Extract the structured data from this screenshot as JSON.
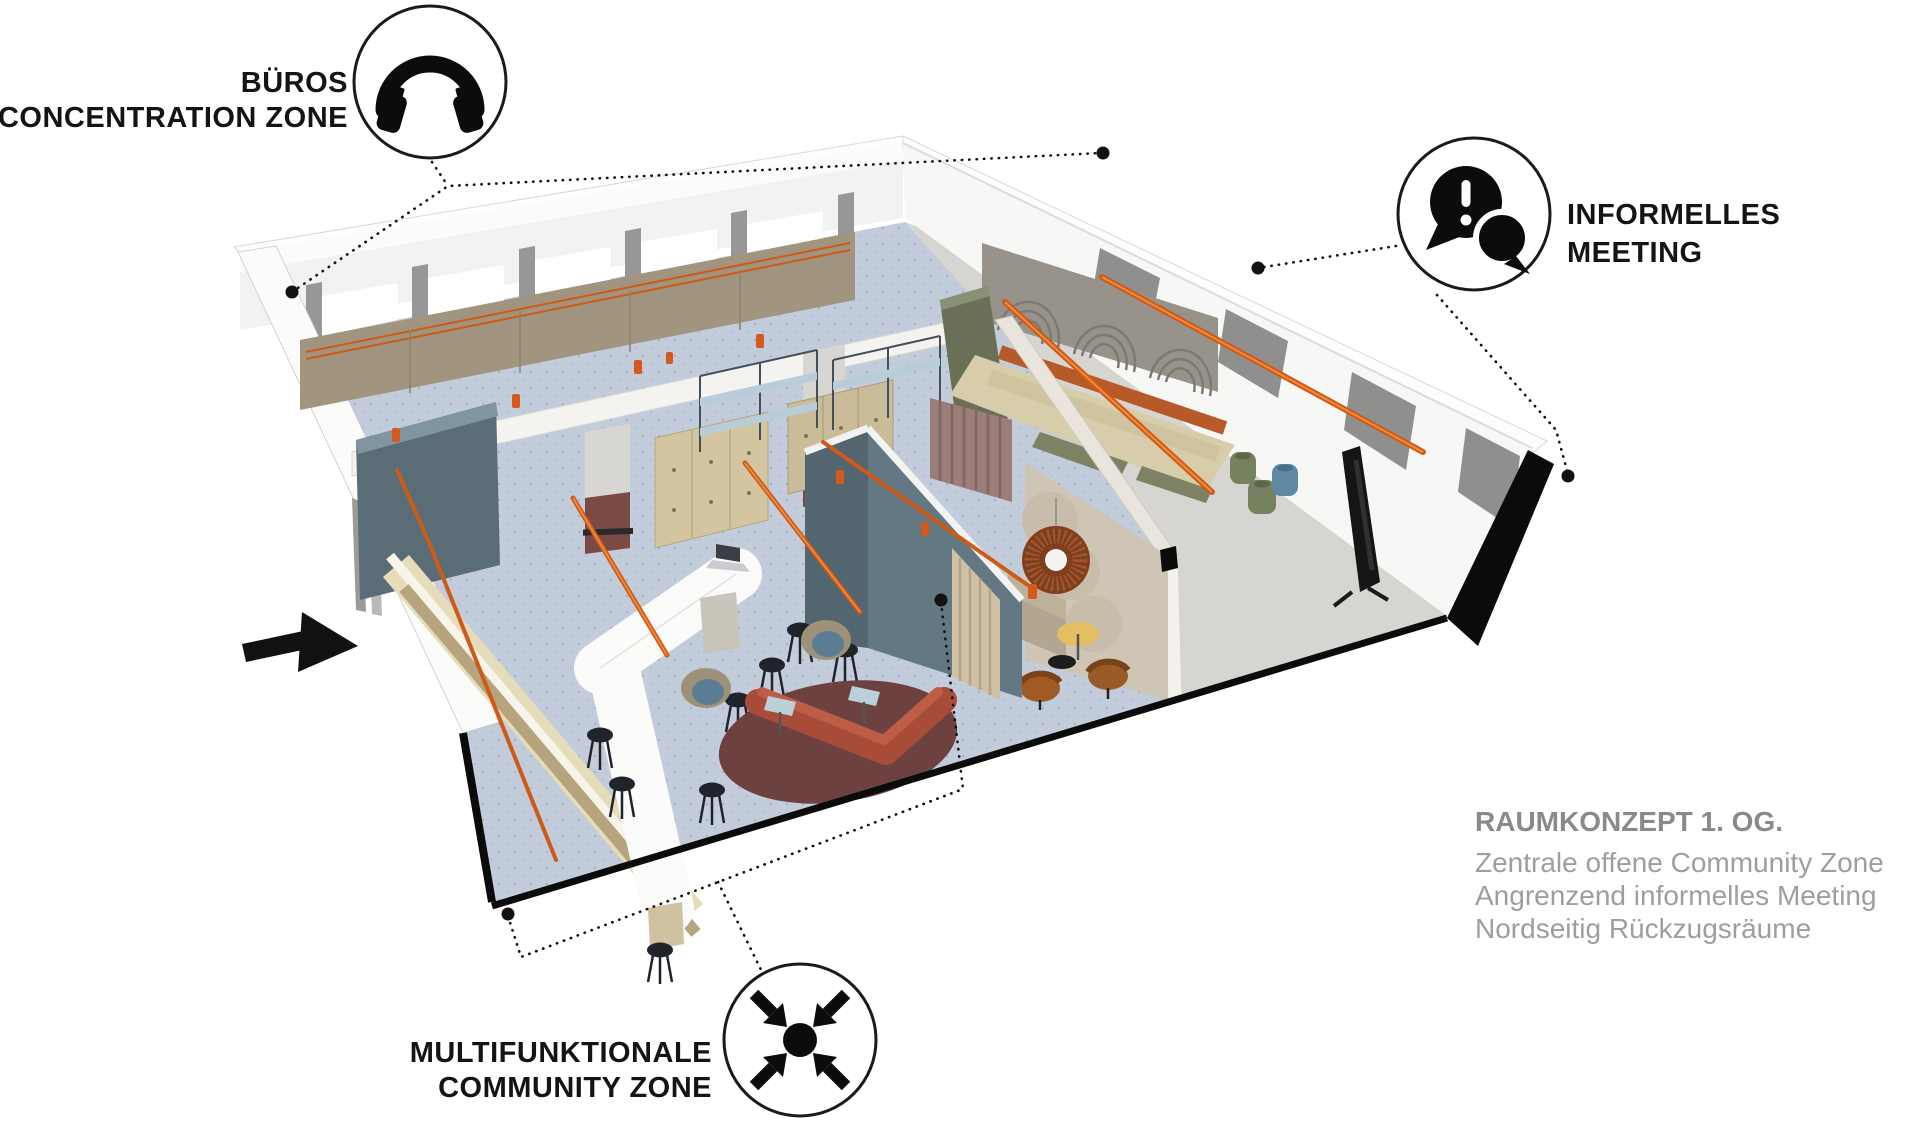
{
  "diagram": {
    "callouts": {
      "offices": {
        "line1": "BÜROS",
        "line2": "CONCENTRATION ZONE",
        "icon": "headphones-icon"
      },
      "meeting": {
        "line1": "INFORMELLES",
        "line2": "MEETING",
        "icon": "chat-alert-icon"
      },
      "community": {
        "line1": "MULTIFUNKTIONALE",
        "line2": "COMMUNITY ZONE",
        "icon": "converging-arrows-icon"
      }
    },
    "caption": {
      "title": "RAUMKONZEPT 1. OG.",
      "line1": "Zentrale offene Community Zone",
      "line2": "Angrenzend informelles Meeting",
      "line3": "Nordseitig Rückzugsräume"
    },
    "colors": {
      "accent_orange": "#cf5a17",
      "community_floor": "#c3ccda",
      "meeting_floor": "#d6d5d1",
      "wall_white": "#f2f2f0",
      "cabinet_greige": "#a2957f",
      "slate_wall": "#5a6d77",
      "maroon_column": "#7b4a45",
      "sofa_rust": "#a84b38",
      "rug_maroon": "#6d4140",
      "bench_beige": "#d8cdaa",
      "olive_green": "#6a7058",
      "curtain_mauve": "#9b7e79",
      "curtain_tan": "#cfc0a6",
      "label_black": "#141414",
      "caption_gray": "#9e9e9e"
    }
  }
}
